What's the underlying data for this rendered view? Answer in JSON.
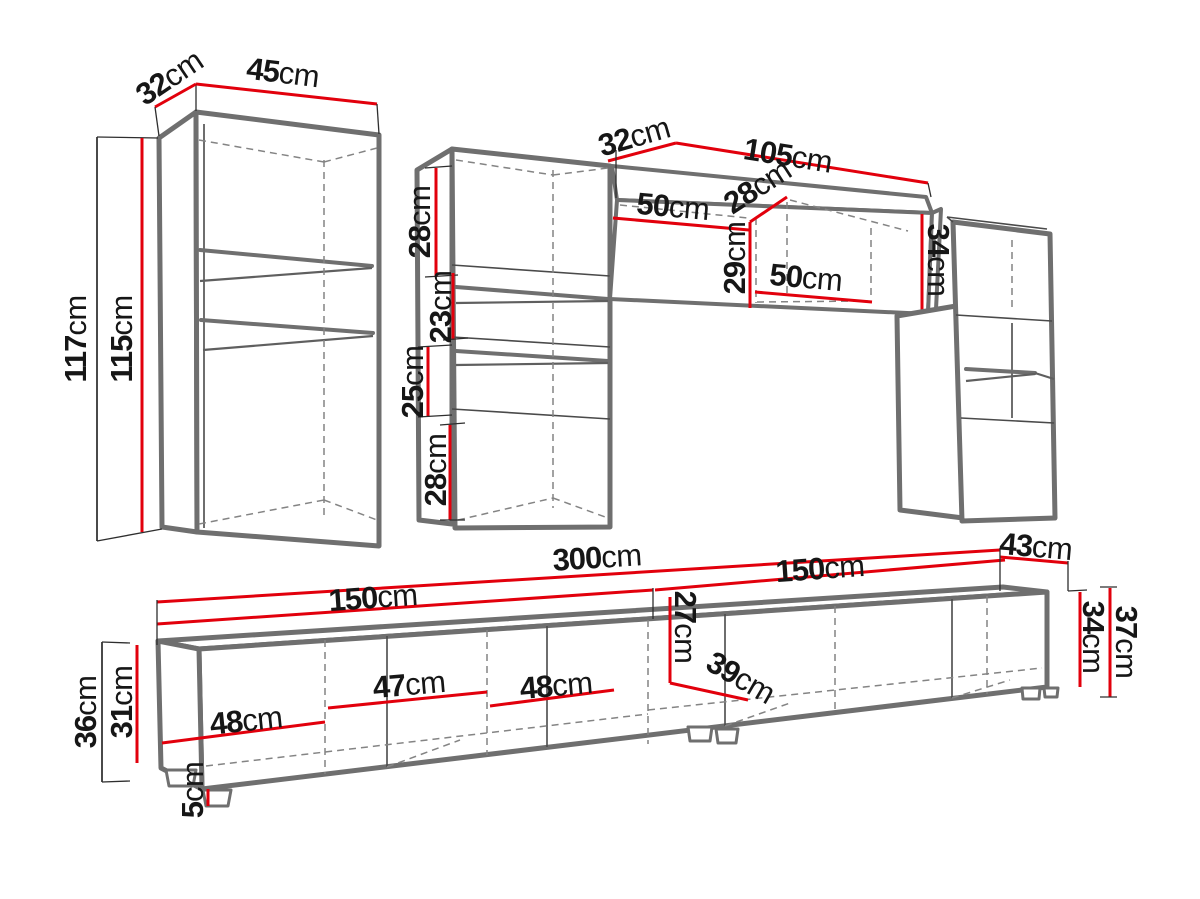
{
  "meta": {
    "description": "Technical dimension diagram of a living-room wall unit set: two tall display cabinets, a hanging shelf unit, a right wall cabinet and a long TV stand",
    "units": "cm",
    "colors": {
      "dimension_line": "#e2000c",
      "furniture_outline": "#6f6f6f",
      "text": "#161616",
      "background": "#ffffff"
    }
  },
  "left_cabinet": {
    "depth": {
      "v": "32",
      "u": "cm"
    },
    "width": {
      "v": "45",
      "u": "cm"
    },
    "height": {
      "v": "117",
      "u": "cm"
    },
    "inner_height": {
      "v": "115",
      "u": "cm"
    }
  },
  "middle_cabinet": {
    "section1": {
      "v": "28",
      "u": "cm"
    },
    "section2": {
      "v": "23",
      "u": "cm"
    },
    "section3": {
      "v": "25",
      "u": "cm"
    },
    "section4": {
      "v": "28",
      "u": "cm"
    }
  },
  "hanging_unit": {
    "depth": {
      "v": "32",
      "u": "cm"
    },
    "width": {
      "v": "105",
      "u": "cm"
    },
    "left_door_width": {
      "v": "50",
      "u": "cm"
    },
    "opening_depth": {
      "v": "28",
      "u": "cm"
    },
    "opening_height": {
      "v": "29",
      "u": "cm"
    },
    "opening_width": {
      "v": "50",
      "u": "cm"
    },
    "end_height": {
      "v": "34",
      "u": "cm"
    }
  },
  "tv_stand": {
    "total_width": {
      "v": "300",
      "u": "cm"
    },
    "left_half_width": {
      "v": "150",
      "u": "cm"
    },
    "right_half_width": {
      "v": "150",
      "u": "cm"
    },
    "depth": {
      "v": "43",
      "u": "cm"
    },
    "door1_width": {
      "v": "48",
      "u": "cm"
    },
    "door2_width": {
      "v": "47",
      "u": "cm"
    },
    "door3_width": {
      "v": "48",
      "u": "cm"
    },
    "inner_height": {
      "v": "27",
      "u": "cm"
    },
    "inner_depth": {
      "v": "39",
      "u": "cm"
    },
    "carcass_height_right": {
      "v": "34",
      "u": "cm"
    },
    "total_height_right": {
      "v": "37",
      "u": "cm"
    },
    "total_height_left": {
      "v": "36",
      "u": "cm"
    },
    "carcass_height_left": {
      "v": "31",
      "u": "cm"
    },
    "foot_height": {
      "v": "5",
      "u": "cm"
    }
  }
}
